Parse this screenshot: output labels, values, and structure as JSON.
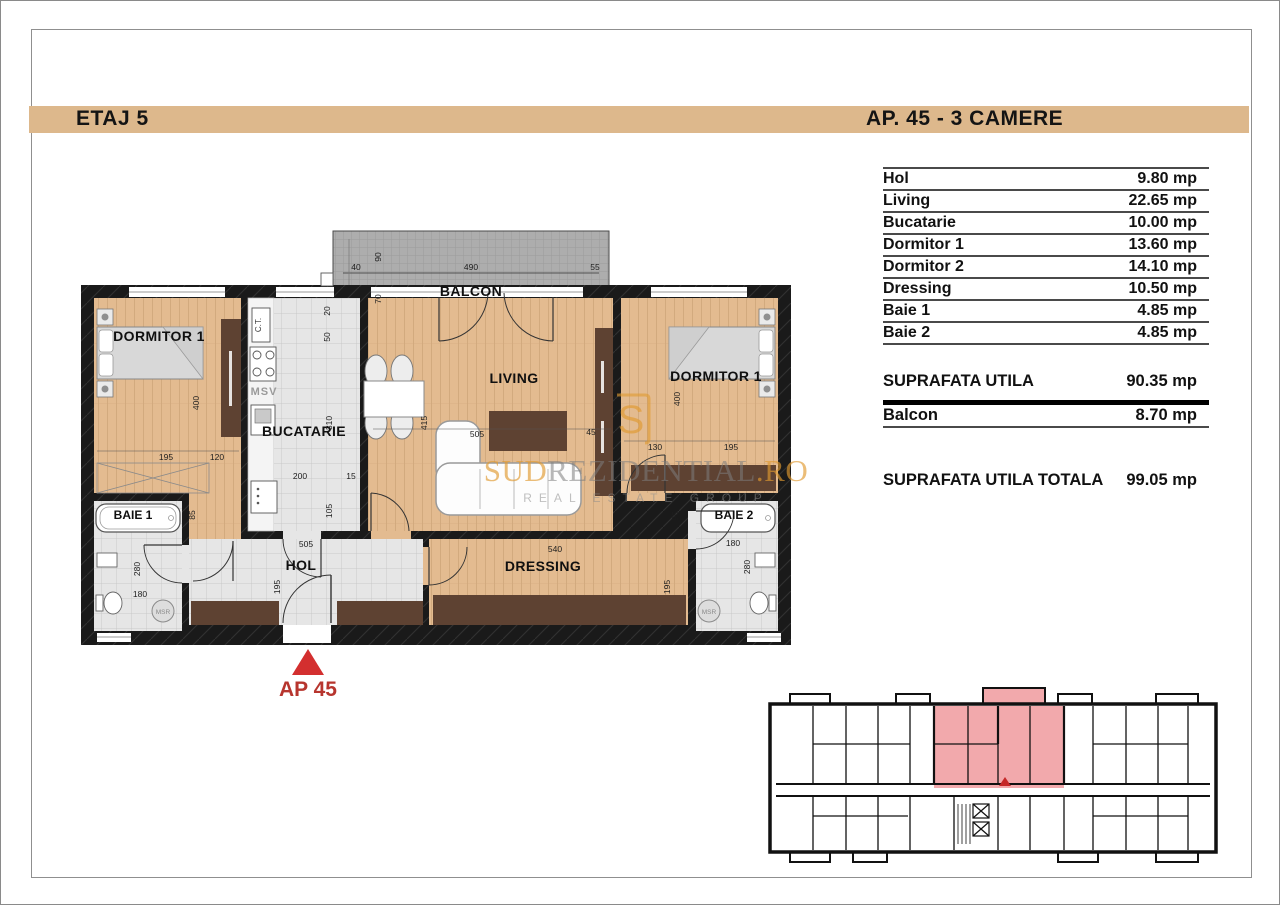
{
  "header": {
    "floor_label": "ETAJ 5",
    "apartment_label": "AP. 45 - 3 CAMERE"
  },
  "area_table": {
    "rows": [
      {
        "label": "Hol",
        "value": "9.80 mp"
      },
      {
        "label": "Living",
        "value": "22.65 mp"
      },
      {
        "label": "Bucatarie",
        "value": "10.00 mp"
      },
      {
        "label": "Dormitor 1",
        "value": "13.60 mp"
      },
      {
        "label": "Dormitor 2",
        "value": "14.10 mp"
      },
      {
        "label": "Dressing",
        "value": "10.50 mp"
      },
      {
        "label": "Baie 1",
        "value": "4.85 mp"
      },
      {
        "label": "Baie 2",
        "value": "4.85 mp"
      }
    ],
    "subtotal": {
      "label": "SUPRAFATA UTILA",
      "value": "90.35 mp"
    },
    "balcony_row": {
      "label": "Balcon",
      "value": "8.70 mp"
    },
    "total": {
      "label": "SUPRAFATA UTILA TOTALA",
      "value": "99.05 mp"
    }
  },
  "plan": {
    "rooms": {
      "dormitor1": "DORMITOR 1",
      "bucatarie": "BUCATARIE",
      "living": "LIVING",
      "dormitor2": "DORMITOR 1",
      "baie1": "BAIE 1",
      "baie2": "BAIE 2",
      "hol": "HOL",
      "dressing": "DRESSING",
      "balcon": "BALCON"
    },
    "annotations": {
      "msv": "MSV",
      "msr_left": "MSR",
      "msr_right": "MSR",
      "ct": "C.T."
    },
    "marker_label": "AP 45",
    "dims": [
      "40",
      "490",
      "55",
      "90",
      "70",
      "195",
      "120",
      "400",
      "85",
      "20",
      "50",
      "310",
      "200",
      "15",
      "105",
      "505",
      "45",
      "415",
      "540",
      "130",
      "195",
      "400",
      "95",
      "180",
      "280",
      "505",
      "195",
      "280",
      "180",
      "195"
    ]
  },
  "watermark": {
    "logo_letter": "S",
    "part1": "SUD",
    "part2": "REZIDENTIAL",
    "part3": ".RO",
    "tagline": "REAL ESTATE GROUP"
  },
  "colors": {
    "header_bar": "#DDB88C",
    "wood_floor": "#E2BA8F",
    "tile_floor": "#E4E4E4",
    "wall": "#181818",
    "balcony": "#ACACAC",
    "furniture_brown": "#5E4232",
    "marker_red": "#D32F2F",
    "watermark_orange": "#E09A2F",
    "keyplan_highlight": "#F2A9AC"
  }
}
